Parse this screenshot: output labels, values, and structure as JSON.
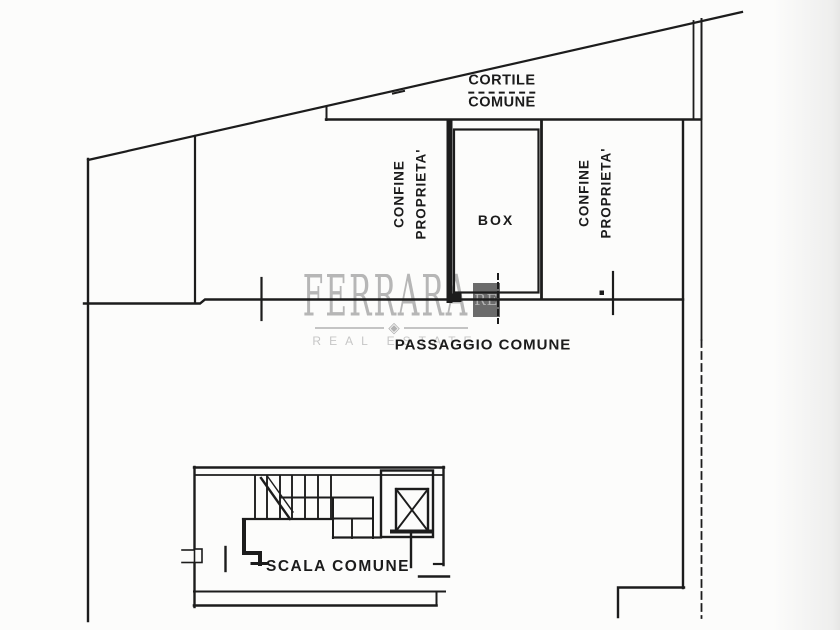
{
  "document": {
    "type": "floor-plan-scan"
  },
  "labels": {
    "cortile": {
      "line1": "CORTILE",
      "line2": "COMUNE"
    },
    "confine": {
      "line1": "CONFINE",
      "line2": "PROPRIETA'"
    },
    "box": "BOX",
    "passaggio": "PASSAGGIO COMUNE",
    "scala": "SCALA COMUNE"
  },
  "watermark": {
    "brand": "FERRARA",
    "initials": "RE",
    "tagline": "REAL ESTATE",
    "diamond_icon": "◈"
  },
  "colors": {
    "ink": "#1c1c1c",
    "paper": "#fcfcfb",
    "watermark_text": "#b6b6b6",
    "watermark_box": "#6b6b6b",
    "watermark_tagline": "#c6c6c6"
  }
}
